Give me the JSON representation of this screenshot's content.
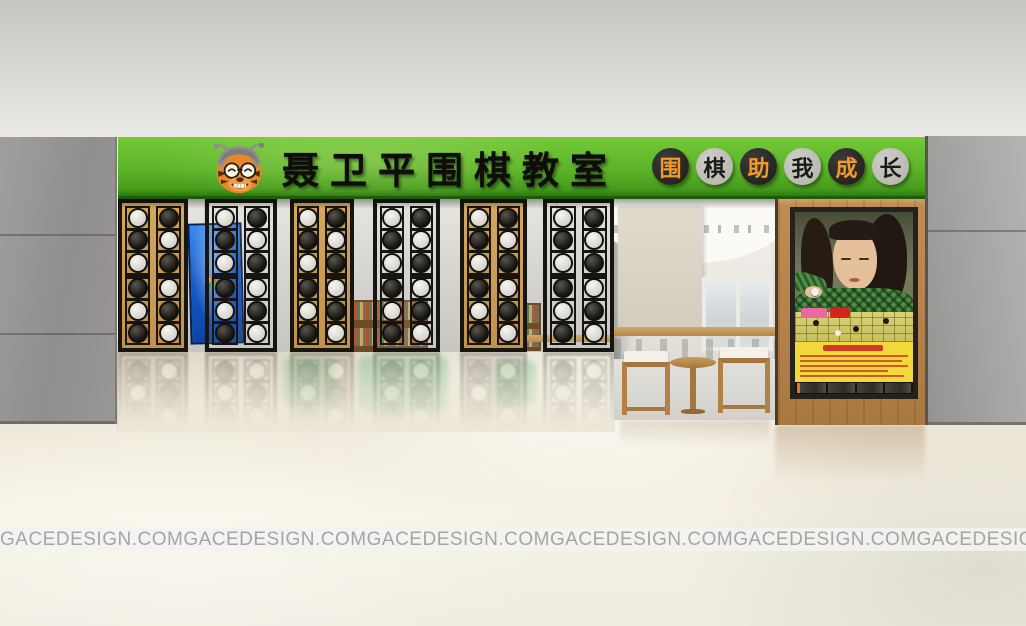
{
  "sign": {
    "title": "聂卫平围棋教室",
    "bg_color": "#5cb328",
    "title_color": "#0e0d0a",
    "mascot_icon": "tiger-mascot",
    "slogan": "围棋助我成长",
    "slogan_circles": [
      {
        "char": "围",
        "circle_color": "#1c1b19",
        "char_color": "#f09a28"
      },
      {
        "char": "棋",
        "circle_color": "#b3b1ac",
        "char_color": "#1a1a18"
      },
      {
        "char": "助",
        "circle_color": "#1c1b19",
        "char_color": "#f09a28"
      },
      {
        "char": "我",
        "circle_color": "#b3b1ac",
        "char_color": "#1a1a18"
      },
      {
        "char": "成",
        "circle_color": "#1c1b19",
        "char_color": "#f09a28"
      },
      {
        "char": "长",
        "circle_color": "#b3b1ac",
        "char_color": "#1a1a18"
      }
    ]
  },
  "watermark": {
    "text": "GACEDESIGN.COM",
    "count": 6
  },
  "screens": {
    "frame_color": "#17150f",
    "wood_color": "#c89a54",
    "stone_colors": {
      "white": "#dbdad4",
      "black": "#1d1c1a"
    },
    "panels": [
      {
        "backing": "wood",
        "columns": [
          [
            "white",
            "black",
            "white",
            "black",
            "white",
            "black"
          ],
          [
            "black",
            "white",
            "black",
            "white",
            "black",
            "white"
          ]
        ]
      },
      {
        "backing": "open",
        "columns": [
          [
            "white",
            "black",
            "white",
            "black",
            "white",
            "black"
          ],
          [
            "black",
            "white",
            "black",
            "white",
            "black",
            "white"
          ]
        ]
      },
      {
        "backing": "wood",
        "columns": [
          [
            "white",
            "black",
            "white",
            "black",
            "white",
            "black"
          ],
          [
            "black",
            "white",
            "black",
            "white",
            "black",
            "white"
          ]
        ]
      },
      {
        "backing": "open",
        "columns": [
          [
            "white",
            "black",
            "white",
            "black",
            "white",
            "black"
          ],
          [
            "black",
            "white",
            "black",
            "white",
            "black",
            "white"
          ]
        ]
      },
      {
        "backing": "wood",
        "columns": [
          [
            "white",
            "black",
            "white",
            "black",
            "white",
            "black"
          ],
          [
            "black",
            "white",
            "black",
            "white",
            "black",
            "white"
          ]
        ]
      },
      {
        "backing": "open",
        "columns": [
          [
            "white",
            "black",
            "white",
            "black",
            "white",
            "black"
          ],
          [
            "black",
            "white",
            "black",
            "white",
            "black",
            "white"
          ]
        ]
      }
    ]
  },
  "tv": {
    "screen_color": "#1459c8"
  },
  "poster": {
    "panel_yellow": "#f2d83a",
    "text_red": "#cf2a1e",
    "frame_color": "#25211c",
    "pillar_wood": "#b5834b"
  }
}
